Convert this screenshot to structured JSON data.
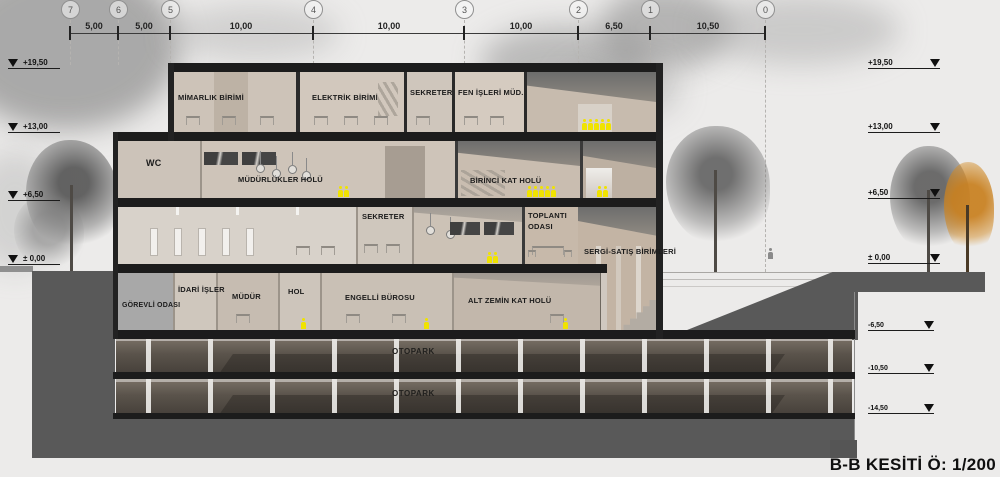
{
  "title": "B-B KESİTİ Ö: 1/200",
  "grid": {
    "bubbles": [
      "7",
      "6",
      "5",
      "4",
      "3",
      "2",
      "1",
      "0"
    ],
    "dims": [
      "5,00",
      "5,00",
      "10,00",
      "10,00",
      "10,00",
      "6,50",
      "10,50"
    ]
  },
  "elevations": {
    "left": [
      "+19,50",
      "+13,00",
      "+6,50",
      "± 0,00"
    ],
    "right_upper": [
      "+19,50",
      "+13,00",
      "+6,50",
      "± 0,00"
    ],
    "right_lower": [
      "-6,50",
      "-10,50",
      "-14,50"
    ]
  },
  "rooms": {
    "f3": [
      "MİMARLIK BİRİMİ",
      "ELEKTRİK BİRİMİ",
      "SEKRETER",
      "FEN İŞLERİ MÜD."
    ],
    "f2": [
      "WC",
      "MÜDÜRLÜKLER HOLÜ",
      "BİRİNCİ KAT HOLÜ"
    ],
    "f1": [
      "SEKRETER",
      "TOPLANTI ODASI",
      "SERGİ-SATIŞ BİRİMLERİ"
    ],
    "f0": [
      "GÖREVLİ ODASI",
      "İDARİ İŞLER",
      "MÜDÜR",
      "HOL",
      "ENGELLİ BÜROSU",
      "ALT ZEMİN KAT HOLÜ"
    ],
    "basement": [
      "OTOPARK",
      "OTOPARK"
    ]
  },
  "colors": {
    "person_accent": "#f0e300",
    "earth": "#595959",
    "slab": "#1c1c1c",
    "autumn_tree": "#c87f1e"
  }
}
